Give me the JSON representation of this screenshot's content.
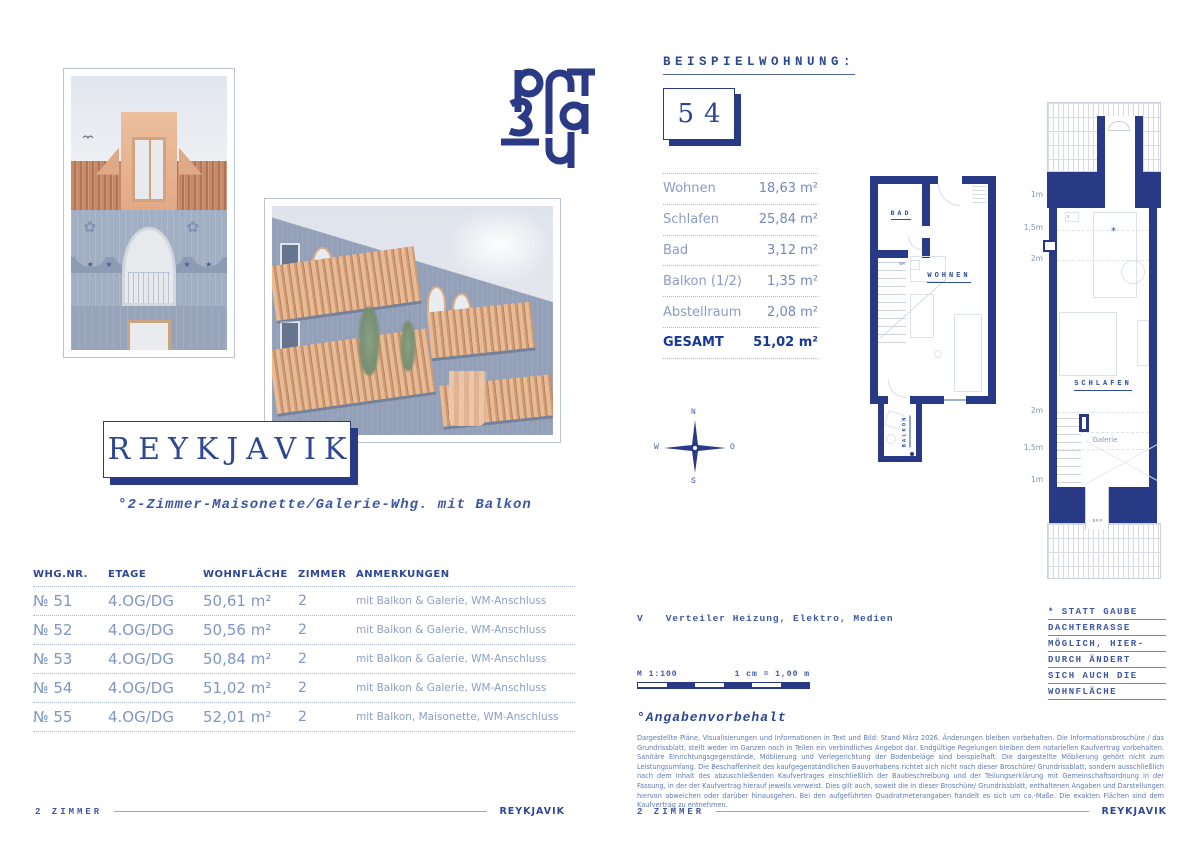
{
  "colors": {
    "navy": "#283a86",
    "blue-head": "#2c4794",
    "blue-mid": "#7289bc",
    "blue-light": "#8a9cc8",
    "blue-note": "#3d57a5",
    "blue-fine": "#5d7ab8",
    "total-blue": "#16389b",
    "line-light": "#a9b7d4",
    "facade-gray": "#a2aec2",
    "roof-terracotta": "#c58a68",
    "dormer-peach": "#e9b893",
    "wood-peach": "#e3b28e"
  },
  "left_page": {
    "title": "REYKJAVIK",
    "subtitle": "°2-Zimmer-Maisonette/Galerie-Whg. mit Balkon",
    "table": {
      "headers": [
        "WHG.NR.",
        "ETAGE",
        "WOHNFLÄCHE",
        "ZIMMER",
        "ANMERKUNGEN"
      ],
      "rows": [
        {
          "nr": "№ 51",
          "etage": "4.OG/DG",
          "flaeche": "50,61 m²",
          "zimmer": "2",
          "anmerkungen": "mit Balkon & Galerie, WM-Anschluss"
        },
        {
          "nr": "№ 52",
          "etage": "4.OG/DG",
          "flaeche": "50,56 m²",
          "zimmer": "2",
          "anmerkungen": "mit Balkon & Galerie, WM-Anschluss"
        },
        {
          "nr": "№ 53",
          "etage": "4.OG/DG",
          "flaeche": "50,84 m²",
          "zimmer": "2",
          "anmerkungen": "mit Balkon & Galerie, WM-Anschluss"
        },
        {
          "nr": "№ 54",
          "etage": "4.OG/DG",
          "flaeche": "51,02 m²",
          "zimmer": "2",
          "anmerkungen": "mit Balkon & Galerie, WM-Anschluss"
        },
        {
          "nr": "№ 55",
          "etage": "4.OG/DG",
          "flaeche": "52,01 m²",
          "zimmer": "2",
          "anmerkungen": "mit Balkon, Maisonette, WM-Anschluss"
        }
      ]
    },
    "footer": {
      "left": "2 ZIMMER",
      "right": "REYKJAVIK"
    }
  },
  "right_page": {
    "beispiel_label": "BEISPIELWOHNUNG:",
    "beispiel_nr": "54",
    "areas": {
      "rows": [
        {
          "label": "Wohnen",
          "value": "18,63 m²"
        },
        {
          "label": "Schlafen",
          "value": "25,84 m²"
        },
        {
          "label": "Bad",
          "value": "3,12 m²"
        },
        {
          "label": "Balkon (1/2)",
          "value": "1,35 m²"
        },
        {
          "label": "Abstellraum",
          "value": "2,08 m²"
        }
      ],
      "total_label": "GESAMT",
      "total_value": "51,02 m²"
    },
    "compass": {
      "n": "N",
      "o": "O",
      "s": "S",
      "w": "W"
    },
    "legend": {
      "symbol": "V",
      "text": "Verteiler Heizung, Elektro, Medien"
    },
    "scale": {
      "ratio": "M 1:100",
      "equiv": "1 cm = 1,00 m"
    },
    "note_lines": [
      "* STATT GAUBE",
      "DACHTERRASSE",
      "MÖGLICH, HIER-",
      "DURCH ÄNDERT",
      "SICH AUCH DIE",
      "WOHNFLÄCHE"
    ],
    "plans": {
      "lower": {
        "bad": "BAD",
        "wohnen": "WOHNEN",
        "balkon": "BALKON",
        "wm": "WM"
      },
      "upper": {
        "schlafen": "SCHLAFEN",
        "galerie": "Galerie",
        "dff": "DFF",
        "star": "*",
        "s": "s",
        "dims": [
          "1m",
          "1,5m",
          "2m",
          "2m",
          "1,5m",
          "1m"
        ]
      }
    },
    "disclaimer": {
      "title": "°Angabenvorbehalt",
      "text": "Dargestellte Pläne, Visualisierungen und Informationen in Text und Bild: Stand März 2026. Änderungen bleiben vorbehalten. Die Informationsbroschüre / das Grundrissblatt, stellt weder im Ganzen noch in Teilen ein verbindliches Angebot dar. Endgültige Regelungen bleiben dem notariellen Kaufvertrag vorbehalten. Sanitäre Einrichtungsgegenstände, Möblierung und Verlegerichtung der Bodenbeläge sind beispielhaft. Die dargestellte Möblierung gehört nicht zum Leistungsumfang. Die Beschaffenheit des kaufgegenständlichen Bauvorhabens richtet sich nicht nach dieser Broschüre/ Grundrissblatt, sondern ausschließlich nach dem Inhalt des abzuschließenden Kaufvertrages einschließlich der Baubeschreibung und der Teilungserklärung mit Gemeinschaftsordnung in der Fassung, in der der Kaufvertrag hierauf jeweils verweist. Dies gilt auch, soweit die in dieser Broschüre/ Grundrissblatt, enthaltenen Angaben und Darstellungen hiervon abweichen oder darüber hinausgehen. Bei den aufgeführten Quadratmeterangaben handelt es sich um ca.-Maße. Die exakten Flächen sind dem Kaufvertrag zu entnehmen."
    },
    "footer": {
      "left": "2 ZIMMER",
      "right": "REYKJAVIK"
    }
  }
}
